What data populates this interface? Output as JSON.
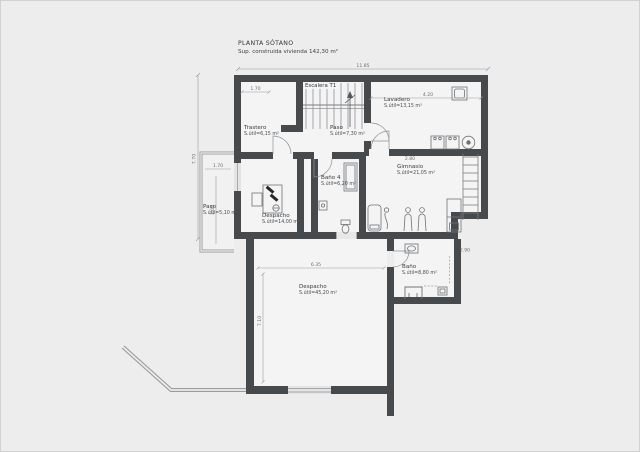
{
  "title": {
    "name": "PLANTA SÓTANO",
    "subtitle": "Sup. construida vivienda 142,30 m²"
  },
  "rooms": {
    "escalera": {
      "name": "Escalera T1",
      "area": ""
    },
    "trastero": {
      "name": "Trastero",
      "area": "S.útil=6,15 m²"
    },
    "paso_sotano": {
      "name": "Paso",
      "area": "S.útil=7,30 m²"
    },
    "lavadero": {
      "name": "Lavadero",
      "area": "S.útil=13,15 m²"
    },
    "bano4": {
      "name": "Baño 4",
      "area": "S.útil=6,20 m²"
    },
    "gimnasio": {
      "name": "Gimnasio",
      "area": "S.útil=21,05 m²"
    },
    "paso_ext": {
      "name": "Paso",
      "area": "S.útil=5,10 m²"
    },
    "despacho1": {
      "name": "Despacho",
      "area": "S.útil=14,00 m²"
    },
    "despacho2": {
      "name": "Despacho",
      "area": "S.útil=45,20 m²"
    },
    "bano": {
      "name": "Baño",
      "area": "S.útil=8,80 m²"
    }
  },
  "dimensions": {
    "overall_width": "11.85",
    "left_height": "7.70",
    "trastero_width": "1.70",
    "lavadero_width": "4.20",
    "gimnasio_width": "2.80",
    "bano_width": "2.90",
    "paso_ext_width": "1.70",
    "paso_ext_height": "3.00",
    "despacho2_width": "6.35",
    "despacho2_height": "7.10"
  },
  "colors": {
    "wall": "#474a4d",
    "background": "#ededee",
    "room_fill": "#f4f4f5",
    "thin_line": "#8f9194"
  }
}
